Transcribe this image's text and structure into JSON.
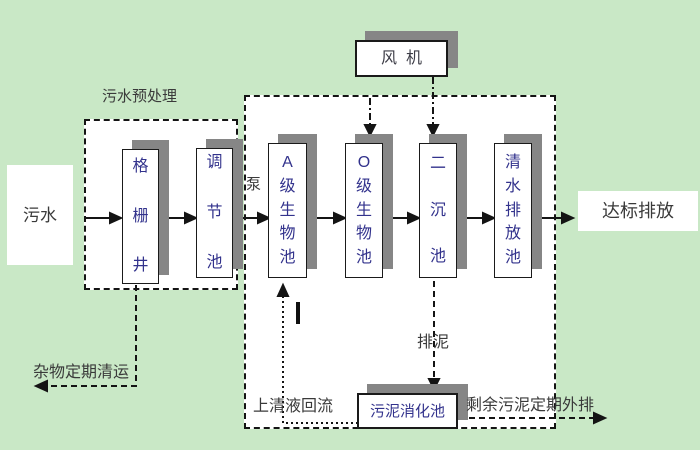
{
  "colors": {
    "background": "#c9e8c6",
    "region_fill": "#ffffff",
    "shadow": "#868686",
    "tank_text": "#32328c",
    "label_text": "#3a3a3a",
    "line": "#141414"
  },
  "nodes": {
    "influent": "污水",
    "grid_well": "格栅井",
    "regulating_tank": "调节池",
    "tank_a": "A级生物池",
    "tank_o": "O级生物池",
    "secondary_clarifier": "二沉池",
    "clearwater_tank": "清水排放池",
    "fan": "风机",
    "digester": "污泥消化池",
    "discharge": "达标排放"
  },
  "labels": {
    "pretreatment": "污水预处理",
    "pump": "泵",
    "debris_removal": "杂物定期清运",
    "supernatant_return": "上清液回流",
    "sludge_drain": "排泥",
    "excess_sludge": "剩余污泥定期外排"
  }
}
